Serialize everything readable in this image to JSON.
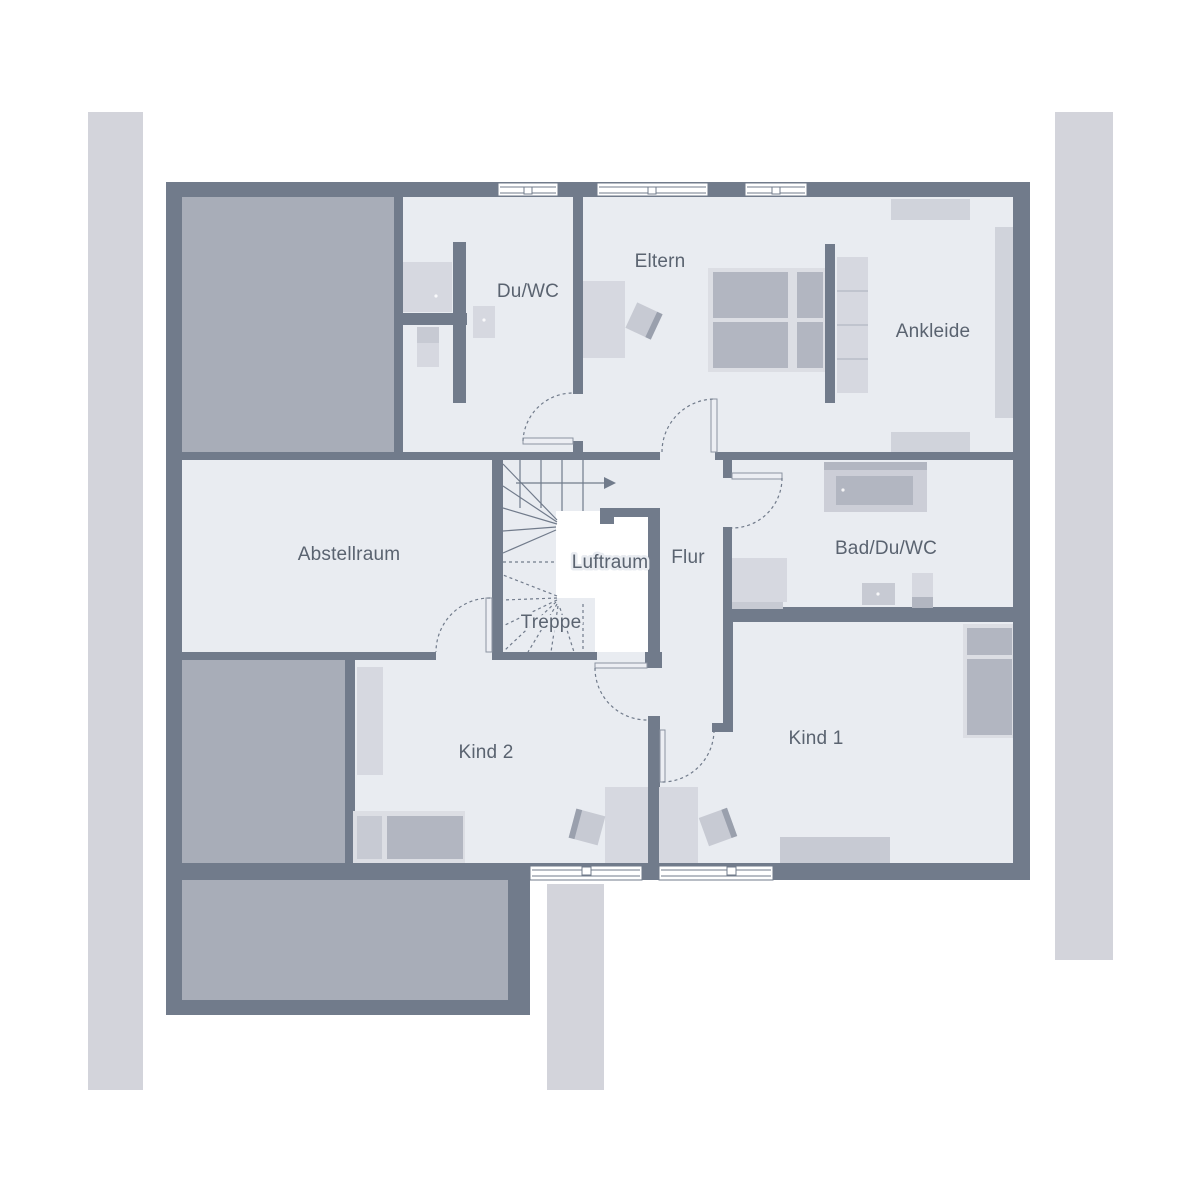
{
  "rooms": {
    "du_wc": {
      "label": "Du/WC"
    },
    "eltern": {
      "label": "Eltern"
    },
    "ankleide": {
      "label": "Ankleide"
    },
    "abstellraum": {
      "label": "Abstellraum"
    },
    "luftraum": {
      "label": "Luftraum"
    },
    "flur": {
      "label": "Flur"
    },
    "treppe": {
      "label": "Treppe"
    },
    "bad_du_wc": {
      "label": "Bad/Du/WC"
    },
    "kind2": {
      "label": "Kind 2"
    },
    "kind1": {
      "label": "Kind 1"
    }
  },
  "colors": {
    "wall": "#717b8b",
    "floor": "#e9ecf1",
    "roof": "#a8adb8",
    "strip": "#d3d4db",
    "furn_light": "#d6d8e0",
    "furn_dark": "#b2b6c1",
    "text": "#5a6370"
  }
}
